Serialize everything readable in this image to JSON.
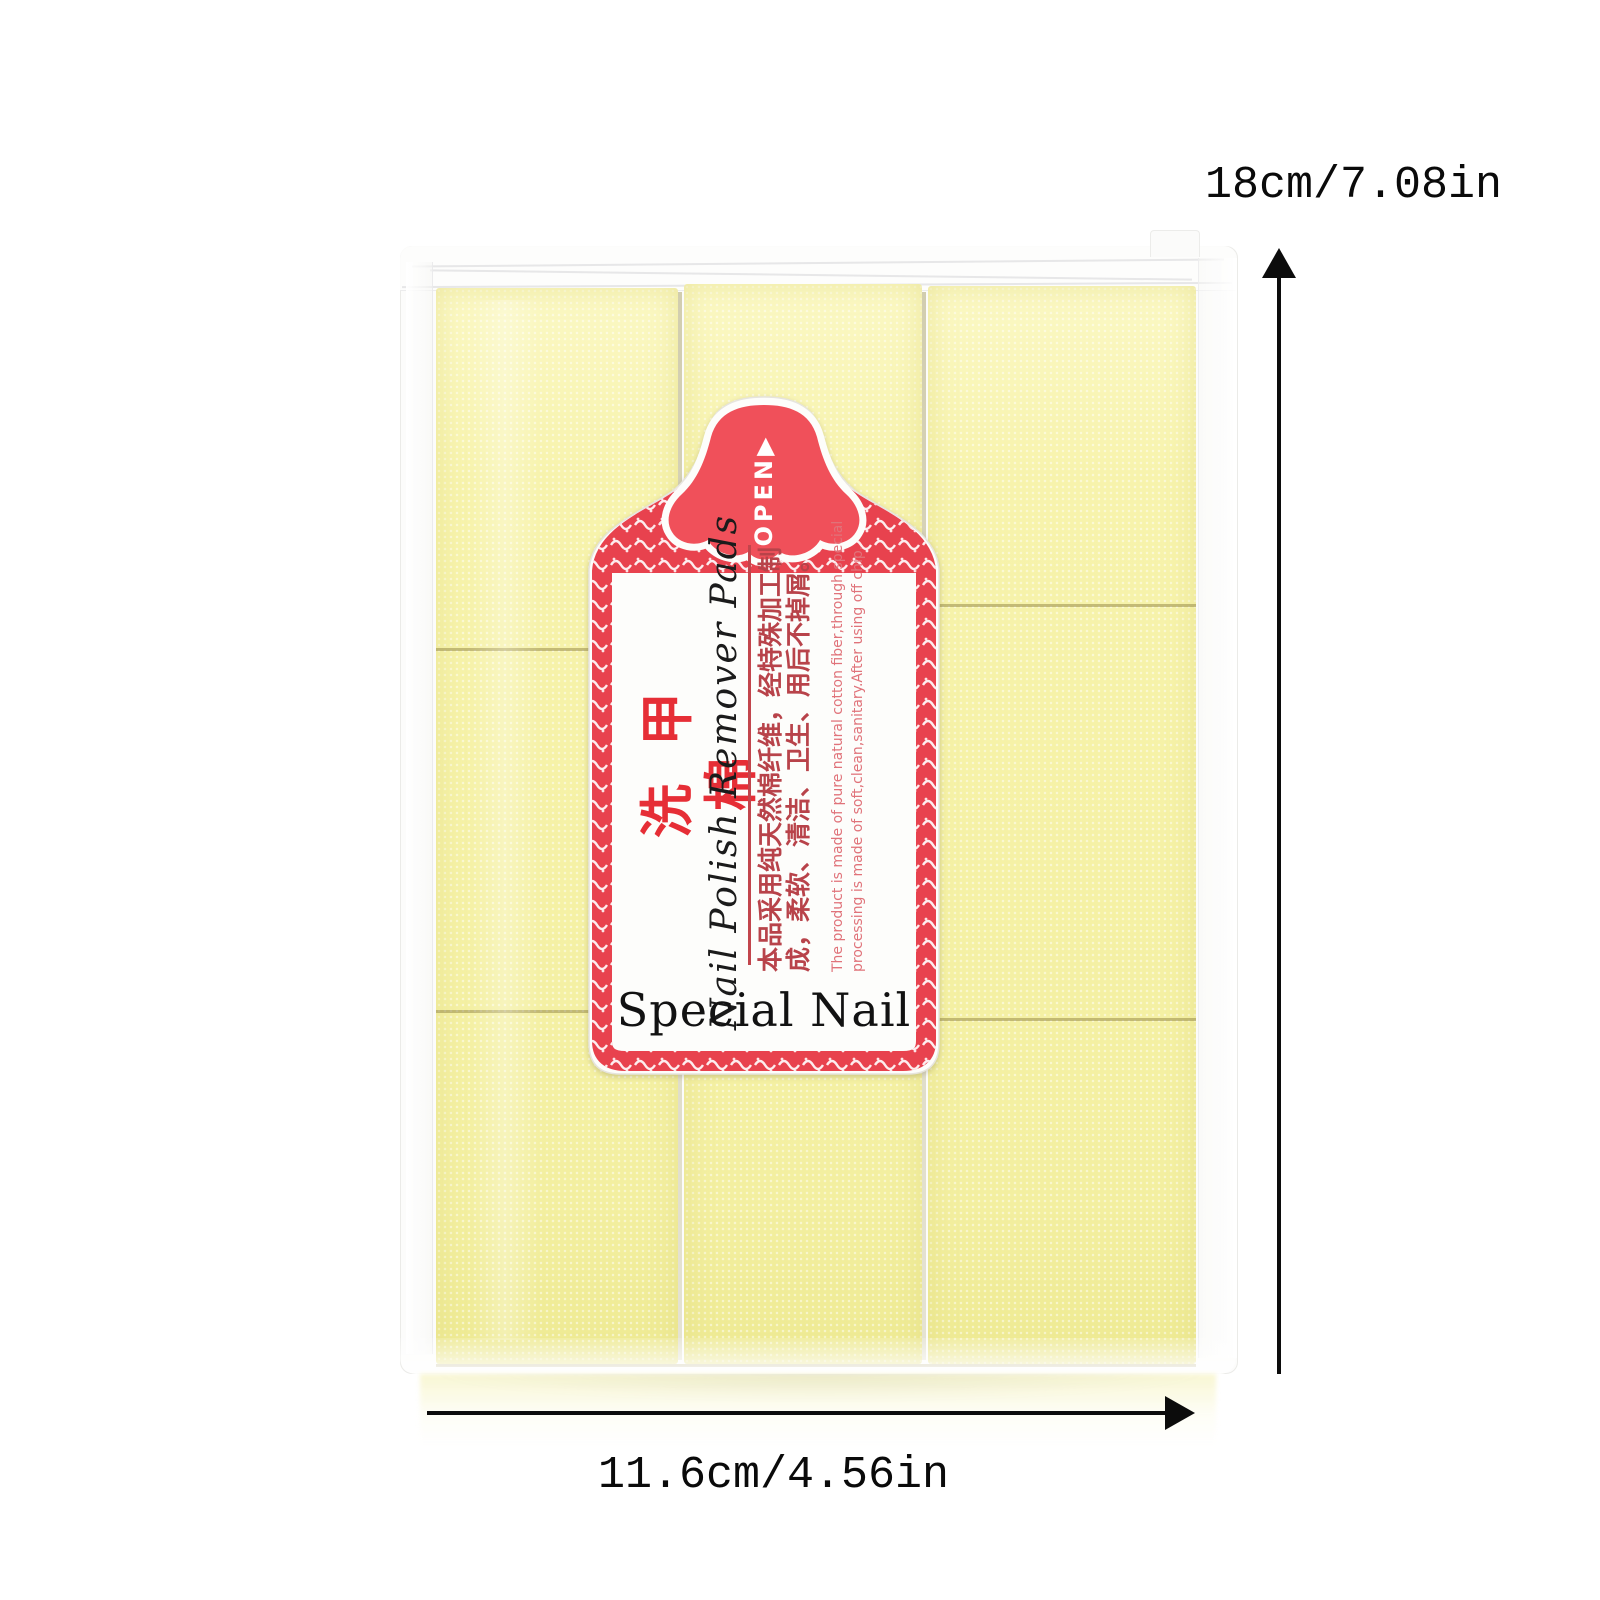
{
  "product": {
    "package": {
      "pad_rows": 3,
      "pad_columns": 3
    },
    "label": {
      "open_text": "OPEN",
      "open_arrow": "▶",
      "title_cn": "洗甲棉",
      "title_en": "Nail Polish Remover Pads",
      "desc_cn_line1": "本品采用纯天然棉纤维，经特殊加工制",
      "desc_cn_line2": "成，柔软、清洁、卫生、用后不掉屑。",
      "desc_en_line1": "The product is made of pure natural cotton fiber,through special",
      "desc_en_line2": "processing is made of soft,clean,sanitary.After using off chip.",
      "brand": "Special Nail"
    }
  },
  "annotations": {
    "height_label": "18cm/7.08in",
    "width_label": "11.6cm/4.56in"
  },
  "colors": {
    "pad_yellow": "#f5f1a5",
    "band_red": "#e8424e",
    "dome_red": "#f0505a",
    "title_red": "#e62e36",
    "desc_cn_red": "#b8434a",
    "desc_en_red": "#e0737a",
    "arrow_black": "#0c0c0c",
    "background": "#ffffff"
  }
}
